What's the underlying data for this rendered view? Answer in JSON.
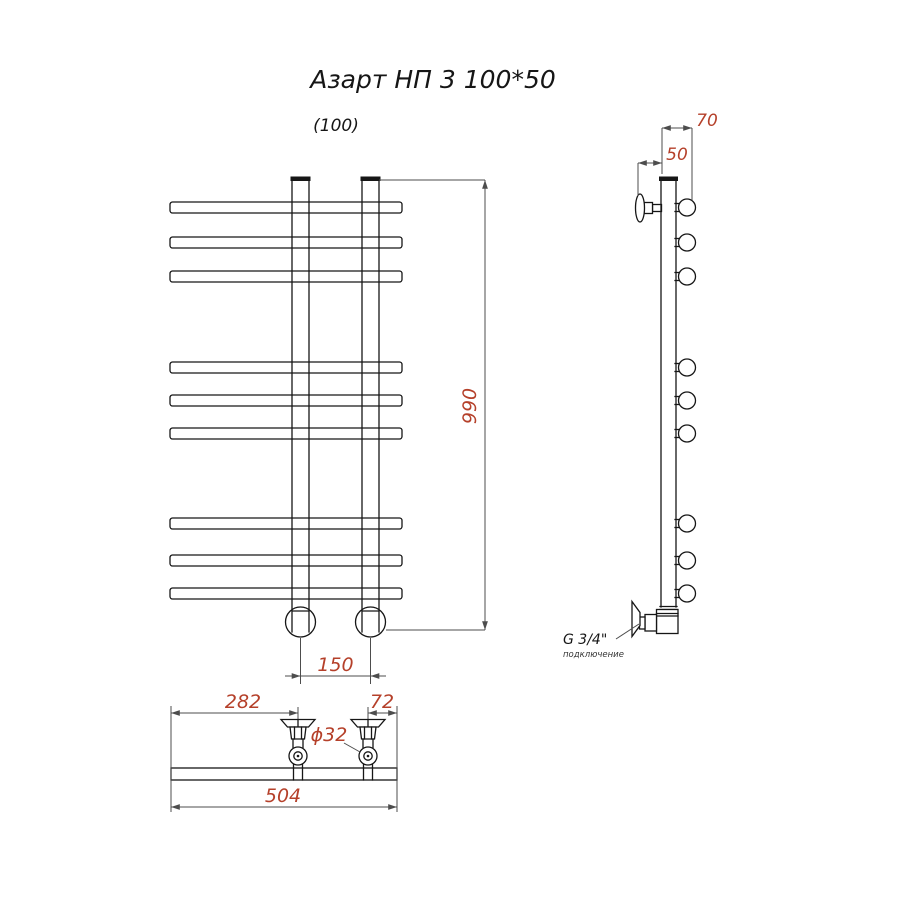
{
  "title": "Азарт НП 3 100*50",
  "variant_note": "(100)",
  "colors": {
    "accent": "#b5402a",
    "ink": "#161616",
    "dim": "#4d4d4d"
  },
  "front_view": {
    "dim_height": "990",
    "dim_bottom_spacing": "150"
  },
  "side_view": {
    "dim_depth": "70",
    "dim_wall_offset": "50",
    "connection_label": "G 3/4\"",
    "connection_note": "подключение"
  },
  "bottom_view": {
    "dim_left": "282",
    "dim_right": "72",
    "dim_diameter": "ϕ32",
    "dim_total_width": "504"
  }
}
